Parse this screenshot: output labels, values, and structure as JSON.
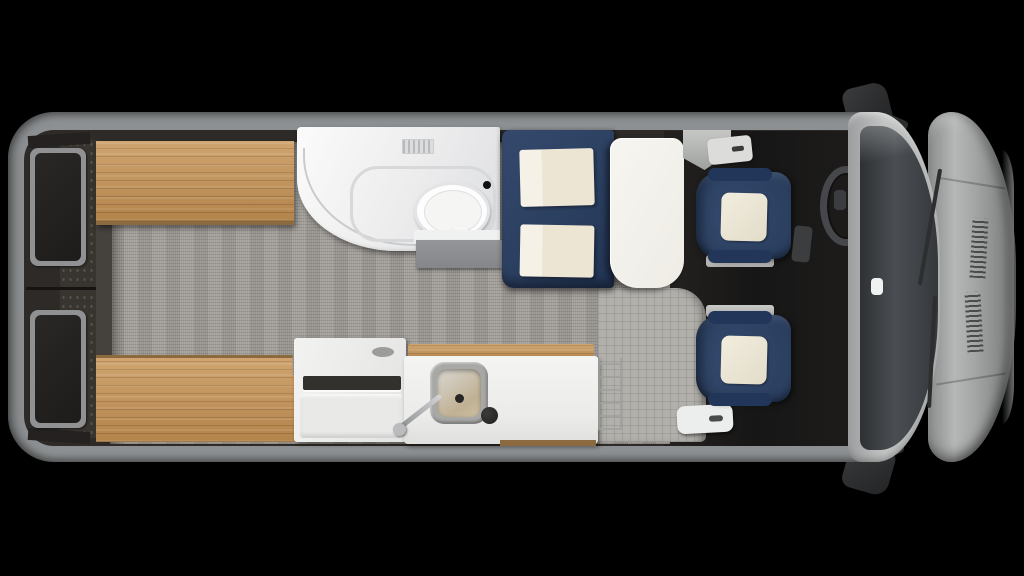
{
  "scene": {
    "description": "Top-down 3D rendered floor plan of a Class B camper van on a black background",
    "background_color": "#000000"
  },
  "colors": {
    "background": "#000000",
    "body": "#8d9092",
    "wall": "#2d2a27",
    "cab": "#171616",
    "carpet": "#9e9a95",
    "entry": "#b2b0ab",
    "wood": "#c79354",
    "wood_dark": "#8a6a3e",
    "navy": "#2b3f60",
    "cream": "#ece5d4",
    "white": "#ebebea",
    "table": "#eeece5",
    "steel": "#a8a8a6",
    "glass": "#4a4e52",
    "hood": "#b6b8b7",
    "mirror": "#232425"
  },
  "components": {
    "van": {
      "label": "Camper van floor plan, top view, front facing right"
    },
    "rear_doors": {
      "label": "Rear cargo doors with windows"
    },
    "bench_top": {
      "label": "Rear twin bed bench, driver side"
    },
    "bench_bottom": {
      "label": "Rear twin bed bench, passenger side"
    },
    "carpet": {
      "label": "Interior carpet floor"
    },
    "entry_floor": {
      "label": "Entry area floor"
    },
    "entry_step": {
      "label": "Entry step trim"
    },
    "wet_bath": {
      "label": "Wet bath"
    },
    "toilet": {
      "label": "Toilet"
    },
    "shower_track": {
      "label": "Shower curtain track"
    },
    "bath_vent": {
      "label": "Bath vent"
    },
    "bath_step": {
      "label": "Bath front cabinet step"
    },
    "dinette_bench": {
      "label": "Dinette bench, navy upholstery"
    },
    "dinette_cushion": {
      "label": "Cream seat cushion"
    },
    "dinette_table": {
      "label": "Dinette table"
    },
    "pillar_trim": {
      "label": "B-pillar entry trim"
    },
    "galley_appliance": {
      "label": "Galley appliance cabinet"
    },
    "galley_counter": {
      "label": "Galley counter with wood rail"
    },
    "sink": {
      "label": "Stainless sink"
    },
    "faucet": {
      "label": "Faucet"
    },
    "burner_knob": {
      "label": "Round control knob"
    },
    "storage_rack": {
      "label": "Counter end wire rack"
    },
    "seat_driver": {
      "label": "Driver captain chair, navy with cream insert"
    },
    "seat_passenger": {
      "label": "Passenger captain chair, navy with cream insert"
    },
    "seat_base": {
      "label": "Seat pedestal base"
    },
    "steering_wheel": {
      "label": "Steering wheel"
    },
    "dashboard": {
      "label": "Dashboard"
    },
    "windshield": {
      "label": "Windshield"
    },
    "rearview_mirror": {
      "label": "Rear-view mirror"
    },
    "wiper": {
      "label": "Windshield wiper"
    },
    "hood": {
      "label": "Hood with vents"
    },
    "mirror_top": {
      "label": "Side mirror, driver side"
    },
    "mirror_bottom": {
      "label": "Side mirror, passenger side"
    }
  }
}
